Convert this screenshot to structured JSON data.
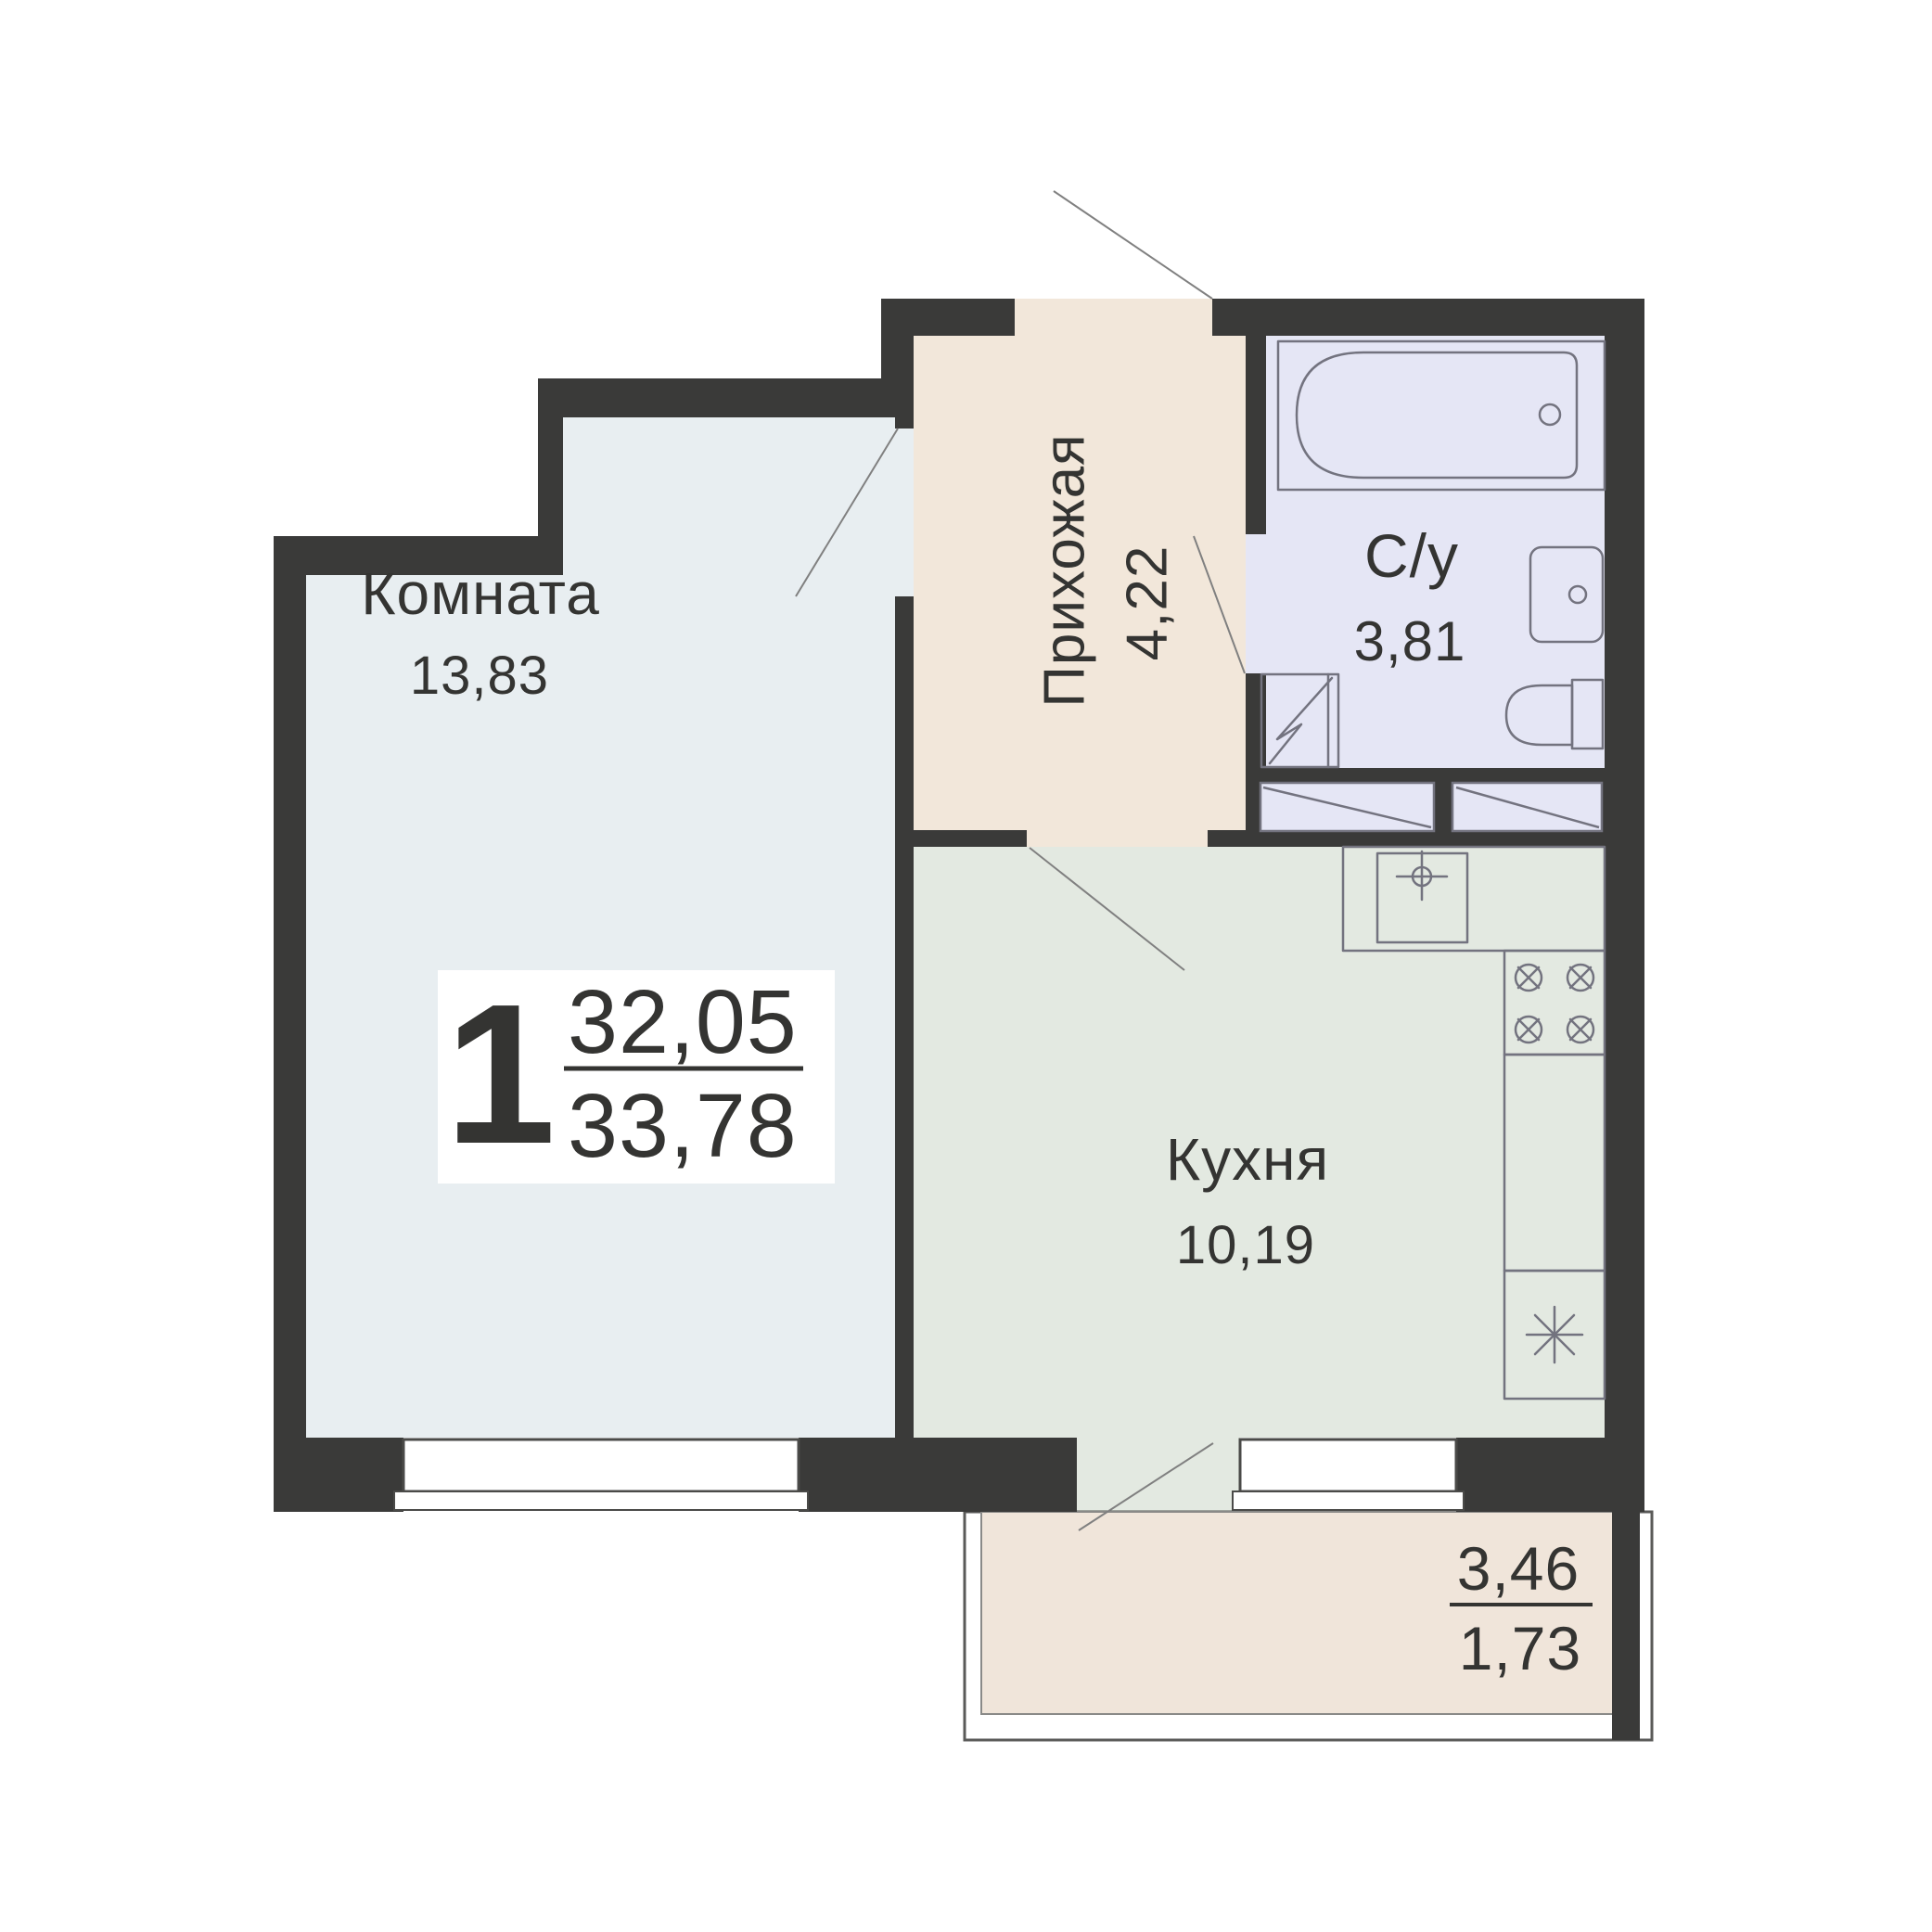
{
  "plan_type": "apartment-floor-plan",
  "rooms": {
    "living": {
      "name": "Комната",
      "area": "13,83"
    },
    "hallway": {
      "name": "Прихожая",
      "area": "4,22"
    },
    "bathroom": {
      "name": "С/у",
      "area": "3,81"
    },
    "kitchen": {
      "name": "Кухня",
      "area": "10,19"
    },
    "balcony": {
      "area_total": "3,46",
      "area_coef": "1,73"
    }
  },
  "summary": {
    "room_count": "1",
    "living_area": "32,05",
    "total_area": "33,78"
  },
  "fixtures": [
    "bathtub",
    "bathroom-sink",
    "toilet",
    "washing-machine",
    "ventilation-shaft",
    "kitchen-sink",
    "stove",
    "refrigerator"
  ],
  "colors": {
    "wall": "#3a3a39",
    "room_living": "#e8eef1",
    "room_hallway": "#f2e7da",
    "room_bathroom": "#e5e6f5",
    "room_kitchen": "#e3e9e1",
    "room_balcony": "#f0e5da",
    "fixture_stroke": "#73737f",
    "swing_line": "#808080",
    "window_border": "#4a4a48",
    "balcony_border": "#5a5a58",
    "text": "#343432"
  }
}
